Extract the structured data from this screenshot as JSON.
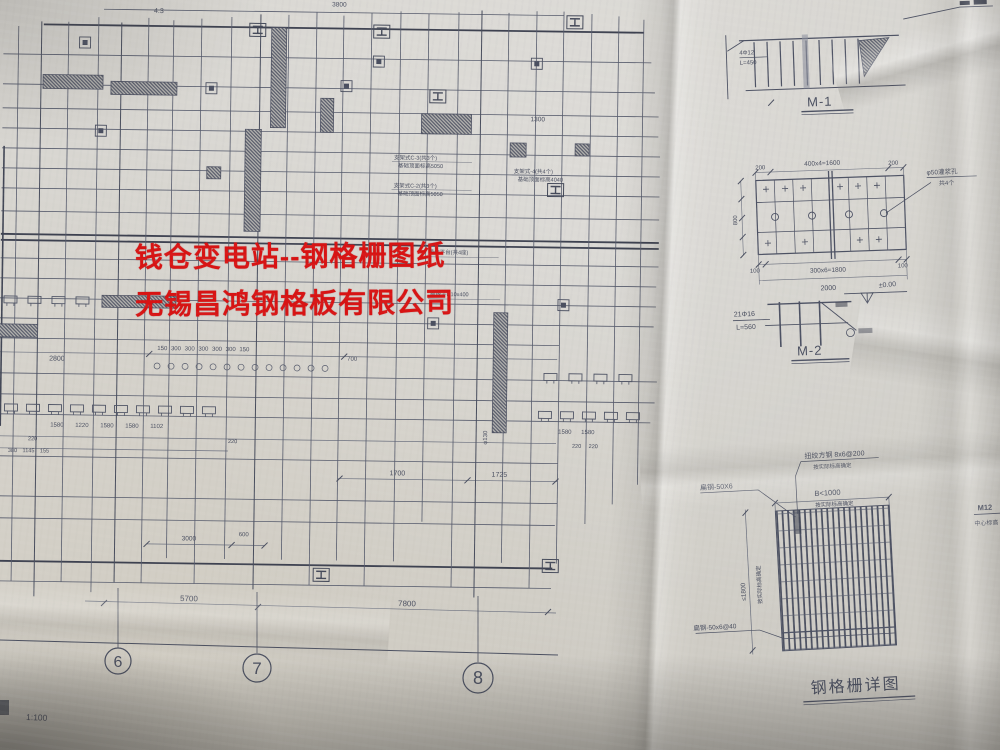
{
  "watermark": {
    "line1": "钱仓变电站--钢格栅图纸",
    "line2": "无锡昌鸿钢格板有限公司",
    "color": "#d81313"
  },
  "plan": {
    "dims": {
      "top_a": "3800",
      "top_b": "4.3",
      "right_1300": "1300",
      "row_2800": "2800",
      "row_300s": "150 300 300 300 300 300 150",
      "d700": "700",
      "row_1580s": "1580 1220 1580 1580 1102",
      "row_1580s_r": "1580 1580",
      "d220a": "220",
      "d220b": "220",
      "d220c": "220 220",
      "row_380": "380 1145 155",
      "d1700": "1700",
      "d1725": "1725",
      "d3000": "3000",
      "d600": "600",
      "phi130": "φ130",
      "span_67": "5700",
      "span_78": "7800"
    },
    "labels": {
      "eq1a": "支架式C-3(共3个)",
      "eq1b": "基础顶面标高5050",
      "eq2a": "支架式C-2(共3个)",
      "eq2b": "基础顶面标高5050",
      "eq3a": "支架式-4(共4个)",
      "eq3b": "基础顶面标高4040",
      "eq4": "操作平台(共4座)",
      "eq5": "绝缘子D10x400"
    },
    "grid_bubbles": {
      "b6": "6",
      "b7": "7",
      "b8": "8"
    },
    "scale_note": "1:100"
  },
  "details": {
    "m1": {
      "title": "M-1",
      "bar": "4Φ12",
      "len": "L=450"
    },
    "m2_plate": {
      "dim_200l": "200",
      "dim_400": "400x4=1600",
      "dim_200r": "200",
      "dim_100l": "100",
      "dim_300": "300x6=1800",
      "dim_100r": "100",
      "dim_2000": "2000",
      "dim_800": "800",
      "hole": "φ50灌浆孔",
      "hole_count": "共4个"
    },
    "m2": {
      "title": "M-2",
      "bar": "21Φ16",
      "len": "L=560",
      "level": "±0.00"
    },
    "grating": {
      "title": "钢格栅详图",
      "twist": "扭绞方钢 8x6@200",
      "note1": "按实际标高确定",
      "flat": "扁钢-50X6",
      "width": "B<1000",
      "note2": "按实际标高确定",
      "height": "≤1800",
      "note3": "按实际标高确定",
      "bearing": "扁钢-50x6@40"
    },
    "edge": {
      "bolt": "M12",
      "center": "中心标高"
    }
  }
}
